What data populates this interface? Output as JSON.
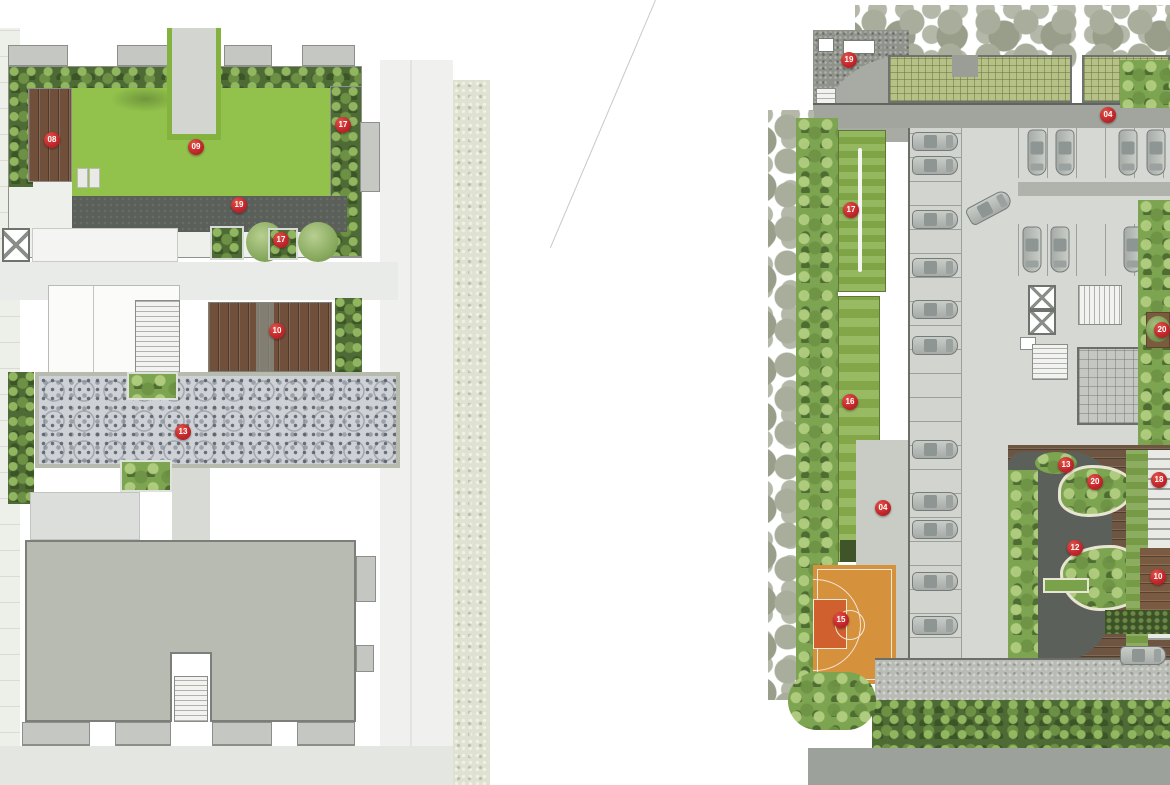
{
  "colors": {
    "marker_red": "#c3272b",
    "lawn_green": "#92c24c",
    "hedge_green": "#4f6b35",
    "wood_brown": "#6d5541",
    "court_orange": "#d6913c",
    "court_key_orange": "#d0612e",
    "roof_gray": "#b8bbb1",
    "path_dark_gray": "#5a5f5a",
    "concrete_gray": "#d5d7d2"
  },
  "left_plan": {
    "markers": [
      {
        "label": "08",
        "x": 52,
        "y": 140
      },
      {
        "label": "09",
        "x": 196,
        "y": 147
      },
      {
        "label": "17",
        "x": 343,
        "y": 125
      },
      {
        "label": "19",
        "x": 239,
        "y": 205
      },
      {
        "label": "17",
        "x": 281,
        "y": 240
      },
      {
        "label": "10",
        "x": 277,
        "y": 331
      },
      {
        "label": "13",
        "x": 183,
        "y": 432
      }
    ]
  },
  "right_plan": {
    "markers": [
      {
        "label": "19",
        "x": 849,
        "y": 60
      },
      {
        "label": "04",
        "x": 1108,
        "y": 115
      },
      {
        "label": "17",
        "x": 851,
        "y": 210
      },
      {
        "label": "16",
        "x": 850,
        "y": 402
      },
      {
        "label": "04",
        "x": 883,
        "y": 508
      },
      {
        "label": "15",
        "x": 841,
        "y": 620
      },
      {
        "label": "20",
        "x": 1162,
        "y": 330
      },
      {
        "label": "13",
        "x": 1066,
        "y": 465
      },
      {
        "label": "20",
        "x": 1095,
        "y": 482
      },
      {
        "label": "18",
        "x": 1159,
        "y": 480
      },
      {
        "label": "12",
        "x": 1075,
        "y": 548
      },
      {
        "label": "10",
        "x": 1158,
        "y": 577
      }
    ]
  }
}
